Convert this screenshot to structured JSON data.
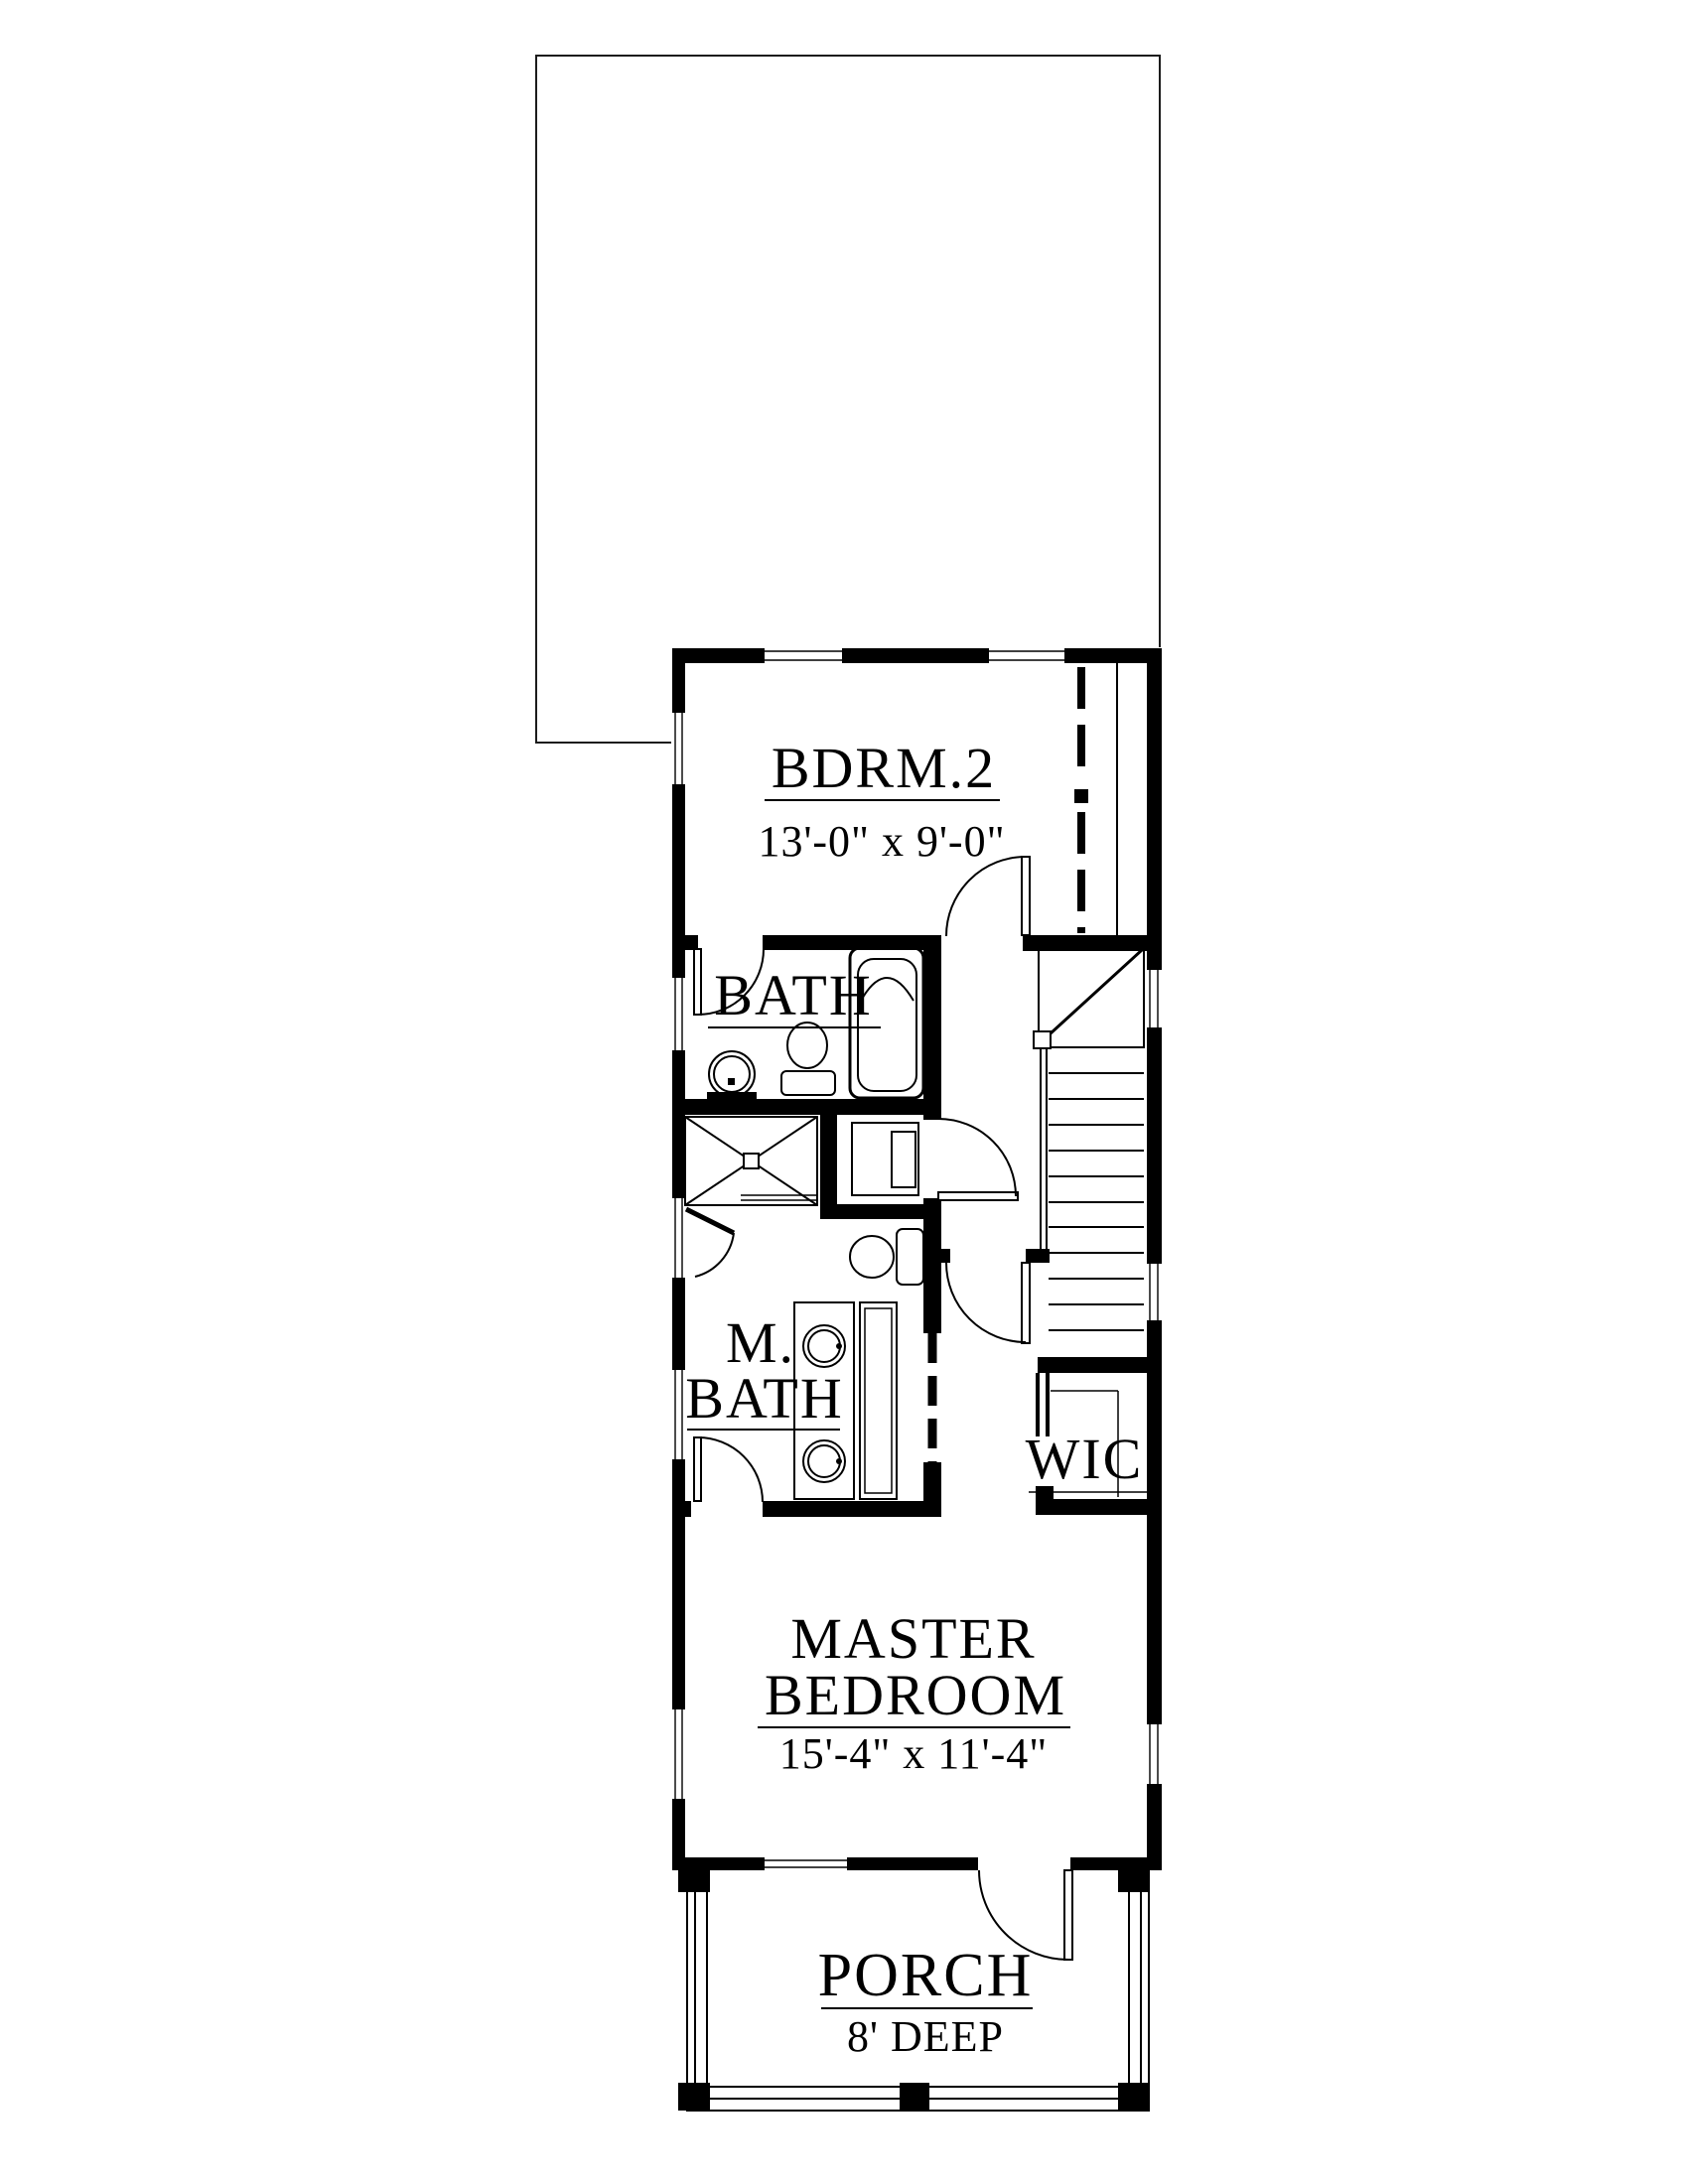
{
  "page": {
    "background": "#ffffff",
    "ink": "#000000",
    "type": "architectural floor plan, second floor"
  },
  "rooms": {
    "bedroom2": {
      "name": "BDRM.2",
      "dims": "13'-0\" x 9'-0\""
    },
    "bath": {
      "name": "BATH"
    },
    "master_bath": {
      "name_line1": "M.",
      "name_line2": "BATH"
    },
    "closet": {
      "name": "WIC"
    },
    "master_bedroom": {
      "name_line1": "MASTER",
      "name_line2": "BEDROOM",
      "dims": "15'-4\" x 11'-4\""
    },
    "porch": {
      "name": "PORCH",
      "dims": "8' DEEP"
    }
  }
}
